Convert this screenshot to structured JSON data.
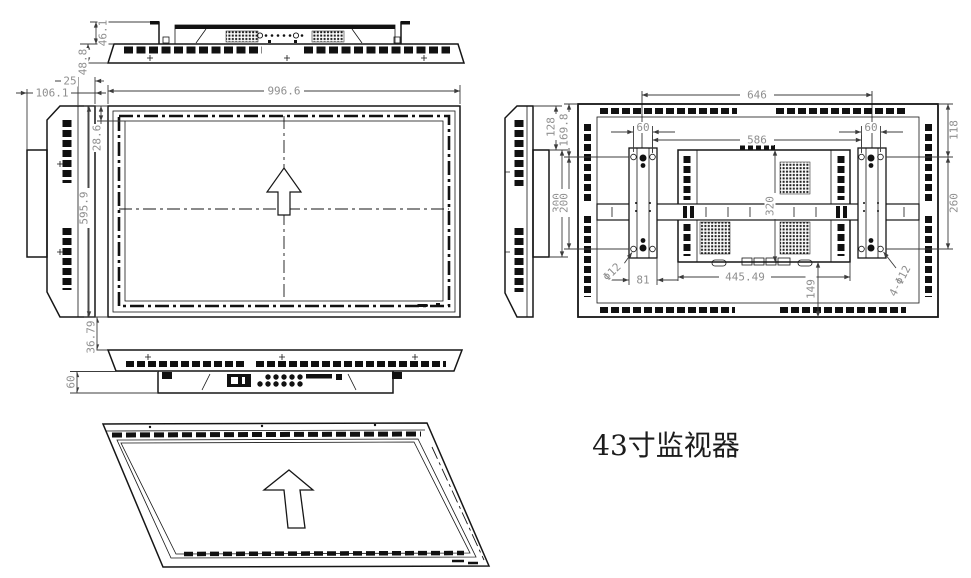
{
  "title": {
    "label": "43寸监视器"
  },
  "colors": {
    "background": "#ffffff",
    "line": "#161616",
    "dim_text": "#8f8f8f"
  },
  "views": {
    "top": {
      "dims": {
        "hook_height": "46.1",
        "depth": "48.8"
      }
    },
    "side_left": {
      "dims": {
        "total_depth": "106.1",
        "bezel_depth": "25"
      }
    },
    "front": {
      "dims": {
        "width": "996.6",
        "bezel_top": "28.6",
        "height": "595.9",
        "gap_below": "36.79"
      }
    },
    "bottom": {
      "dims": {
        "housing_depth": "60"
      }
    },
    "rear_side": {
      "dims": {
        "top_offset": "128",
        "bracket_height": "300"
      }
    },
    "rear": {
      "dims": {
        "mount_span": "646",
        "hole_pitch_left": "60",
        "hole_pitch_right": "60",
        "vesa_span": "586",
        "top_to_hole": "169.8",
        "hole_pitch_vertical": "200",
        "right_top_offset": "118",
        "right_hole_span": "260",
        "box_height": "320",
        "bracket_width": "81",
        "box_width": "445.49",
        "box_to_bottom": "149",
        "hole_diameter": "Φ12",
        "hole_callout": "4-Φ12"
      }
    }
  }
}
